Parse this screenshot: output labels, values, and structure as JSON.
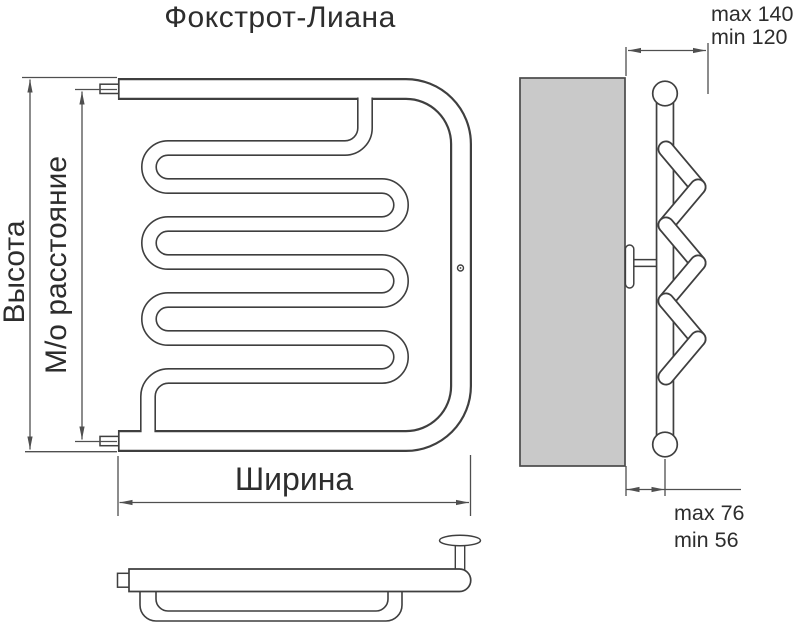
{
  "title": "Фокстрот-Лиана",
  "colors": {
    "line": "#3f3f3f",
    "dimension": "#4f4f4f",
    "wall_fill": "#c9c9c9",
    "text": "#2d2d2d",
    "background": "#ffffff"
  },
  "front_view": {
    "height_label": "Высота",
    "center_distance_label": "М/о расстояние",
    "width_label": "Ширина"
  },
  "side_view": {
    "wall_clearance_top": {
      "max": "max 140",
      "min": "min 120"
    },
    "wall_clearance_bottom": {
      "max": "max 76",
      "min": "min 56"
    }
  }
}
